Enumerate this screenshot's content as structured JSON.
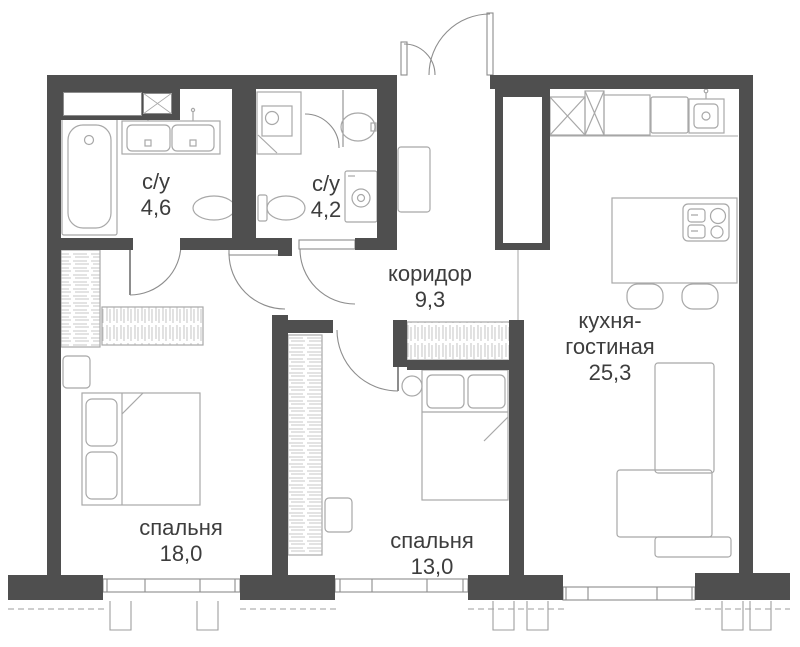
{
  "plan": {
    "rooms": [
      {
        "id": "bathroom-1",
        "label": "с/у",
        "area": "4,6"
      },
      {
        "id": "bathroom-2",
        "label": "с/у",
        "area": "4,2"
      },
      {
        "id": "corridor",
        "label": "коридор",
        "area": "9,3"
      },
      {
        "id": "kitchen-living",
        "label_line1": "кухня-",
        "label_line2": "гостиная",
        "area": "25,3"
      },
      {
        "id": "bedroom-big",
        "label": "спальня",
        "area": "18,0"
      },
      {
        "id": "bedroom-small",
        "label": "спальня",
        "area": "13,0"
      }
    ],
    "colors": {
      "wall": "#4f4f4f",
      "fixture": "#a8a8a8",
      "door": "#8d8d8d",
      "text": "#3d3d3d"
    }
  }
}
